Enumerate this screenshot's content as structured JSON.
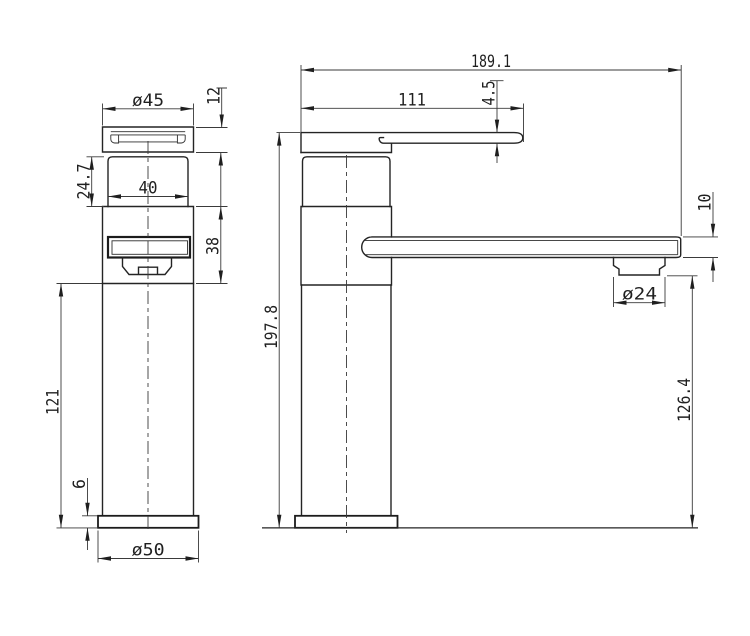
{
  "drawing": {
    "type": "technical-dimension-drawing",
    "subject": "basin mixer tap, front and side orthographic views",
    "colors": {
      "line": "#242424",
      "dim_line": "#3a3a3a",
      "text": "#1f1f1f",
      "background": "#ffffff"
    }
  },
  "labels": {
    "front": {
      "cap_diameter": "ø45",
      "cap_height": "12",
      "neck_height": "24.7",
      "neck_width": "40",
      "upper_body_height": "38",
      "column_height": "121",
      "base_thickness": "6",
      "base_diameter": "ø50"
    },
    "side": {
      "overall_reach": "189.1",
      "handle_reach": "111",
      "lever_thickness": "4.5",
      "spout_thickness": "10",
      "aerator_diameter": "ø24",
      "spout_clearance": "126.4",
      "overall_height": "197.8"
    }
  }
}
